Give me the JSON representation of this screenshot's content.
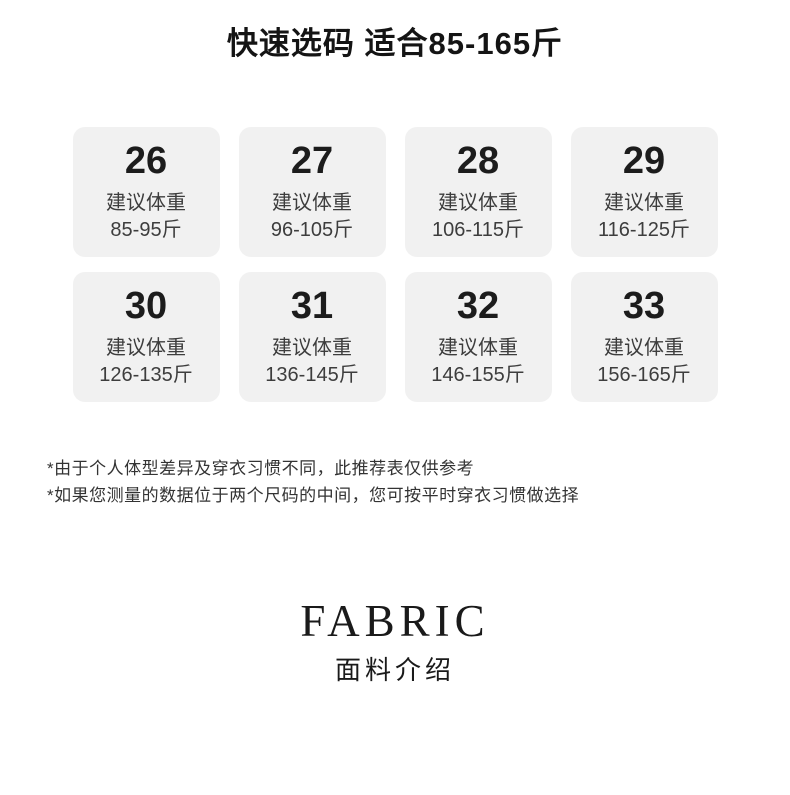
{
  "header": {
    "title": "快速选码 适合85-165斤"
  },
  "size_chart": {
    "cards": [
      {
        "size": "26",
        "label": "建议体重",
        "range": "85-95斤"
      },
      {
        "size": "27",
        "label": "建议体重",
        "range": "96-105斤"
      },
      {
        "size": "28",
        "label": "建议体重",
        "range": "106-115斤"
      },
      {
        "size": "29",
        "label": "建议体重",
        "range": "116-125斤"
      },
      {
        "size": "30",
        "label": "建议体重",
        "range": "126-135斤"
      },
      {
        "size": "31",
        "label": "建议体重",
        "range": "136-145斤"
      },
      {
        "size": "32",
        "label": "建议体重",
        "range": "146-155斤"
      },
      {
        "size": "33",
        "label": "建议体重",
        "range": "156-165斤"
      }
    ]
  },
  "notes": {
    "note1": "*由于个人体型差异及穿衣习惯不同，此推荐表仅供参考",
    "note2": "*如果您测量的数据位于两个尺码的中间，您可按平时穿衣习惯做选择"
  },
  "fabric_section": {
    "heading_en": "FABRIC",
    "heading_zh": "面料介绍"
  },
  "colors": {
    "card_bg": "#f1f1f1",
    "text_primary": "#1c1c1c",
    "text_secondary": "#3d3d3d"
  }
}
